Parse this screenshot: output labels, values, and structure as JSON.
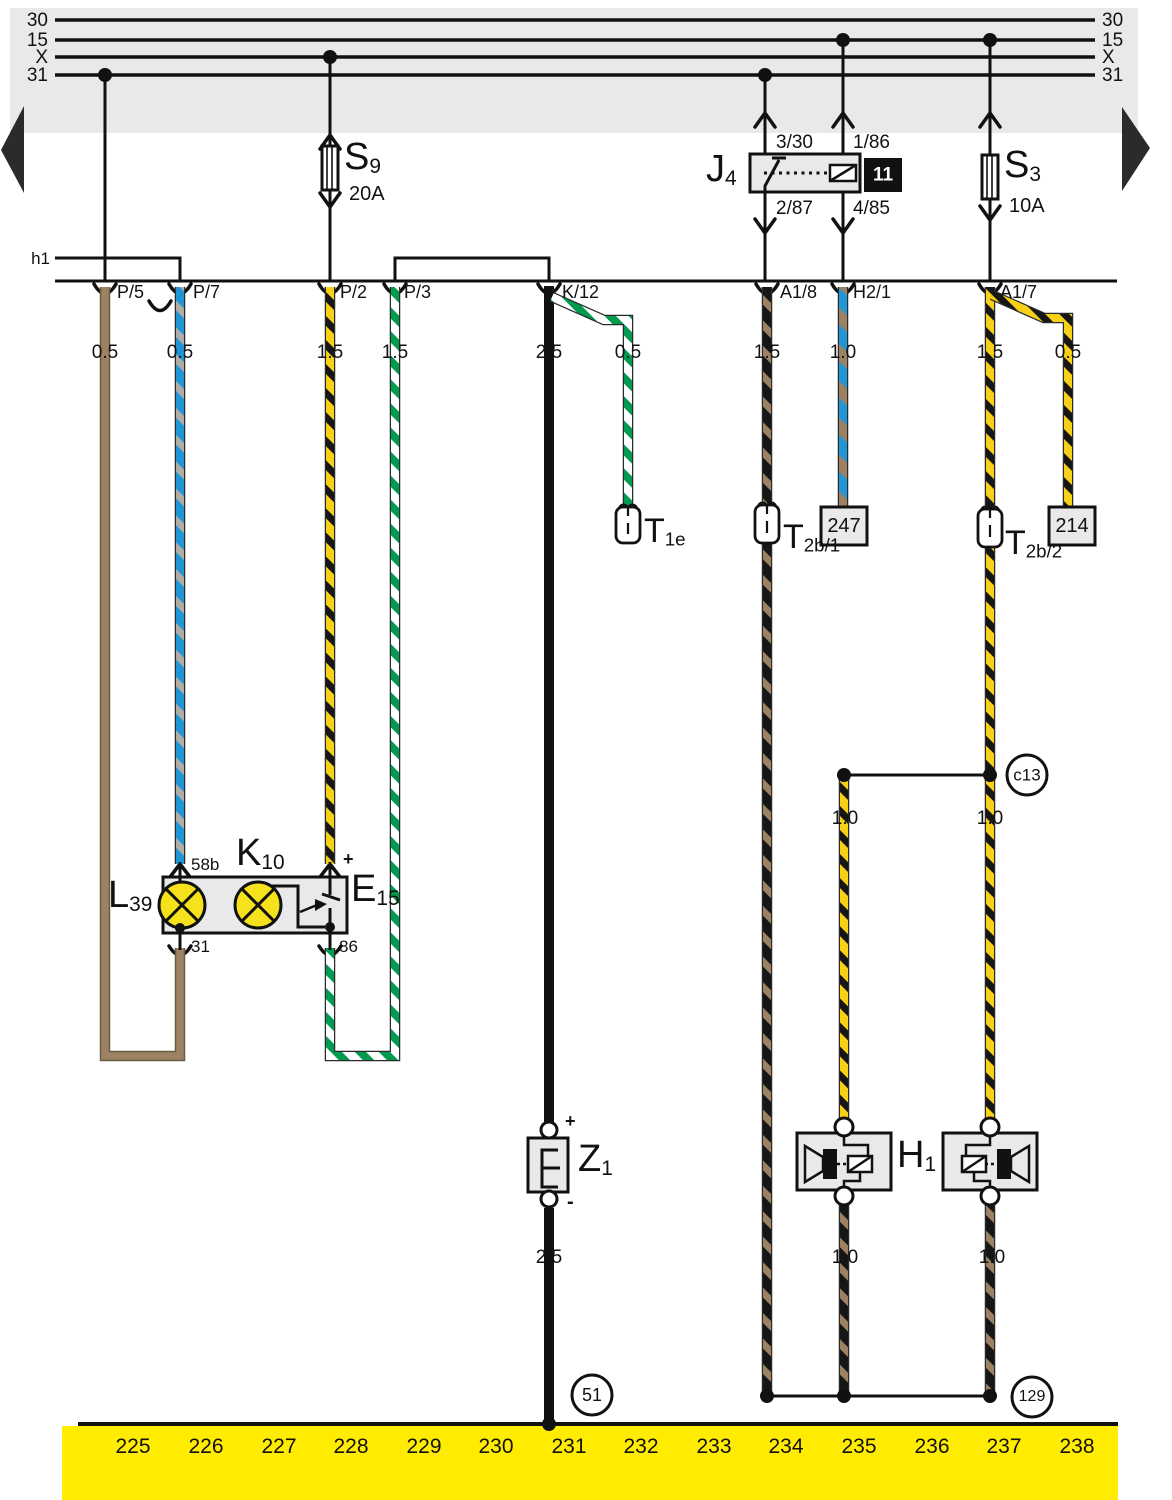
{
  "diagram": {
    "bus_left": [
      "30",
      "15",
      "X",
      "31"
    ],
    "bus_right": [
      "30",
      "15",
      "X",
      "31"
    ],
    "h1": "h1",
    "s9": {
      "id": "S",
      "sub": "9",
      "rating": "20A"
    },
    "s3": {
      "id": "S",
      "sub": "3",
      "rating": "10A"
    },
    "j4": {
      "id": "J",
      "sub": "4",
      "code": "11",
      "pin_tl": "3/30",
      "pin_tr": "1/86",
      "pin_bl": "2/87",
      "pin_br": "4/85"
    },
    "terminals": {
      "p5": "P/5",
      "p7": "P/7",
      "p2": "P/2",
      "p3": "P/3",
      "k12": "K/12",
      "a18": "A1/8",
      "h21": "H2/1",
      "a17": "A1/7"
    },
    "gauges_row": [
      "0.5",
      "0.5",
      "1.5",
      "1.5",
      "2.5",
      "0.5",
      "1.5",
      "1.0",
      "1.5",
      "0.5"
    ],
    "gauges_mid": [
      "1.0",
      "1.0"
    ],
    "gauges_bottom": [
      "2.5",
      "1.0",
      "1.0"
    ],
    "t1e": {
      "id": "T",
      "sub": "1e"
    },
    "t2b1": {
      "id": "T",
      "sub": "2b/1"
    },
    "t2b2": {
      "id": "T",
      "sub": "2b/2"
    },
    "box247": "247",
    "box214": "214",
    "k10": {
      "id": "K",
      "sub": "10"
    },
    "l39": {
      "id": "L",
      "sub": "39"
    },
    "e15": {
      "id": "E",
      "sub": "15"
    },
    "k10_pins": {
      "p58b": "58b",
      "plus": "+",
      "p31": "31",
      "p86": "86"
    },
    "z1": {
      "id": "Z",
      "sub": "1",
      "plus": "+",
      "minus": "-"
    },
    "horn_h1": {
      "id": "H",
      "sub": "1"
    },
    "ref_c13": "c13",
    "ref_51": "51",
    "ref_129": "129",
    "tracks": [
      "225",
      "226",
      "227",
      "228",
      "229",
      "230",
      "231",
      "232",
      "233",
      "234",
      "235",
      "236",
      "237",
      "238"
    ],
    "colors": {
      "gray_band": "#e9e9e9",
      "yellow_band": "#ffec00",
      "wire_brown": "#9c8262",
      "wire_blue": "#2196d6",
      "wire_yellow": "#f7d117",
      "wire_green": "#009b4e",
      "wire_gray": "#b0aca6",
      "lamp_yellow": "#f5e11c",
      "line_black": "#111111"
    }
  }
}
